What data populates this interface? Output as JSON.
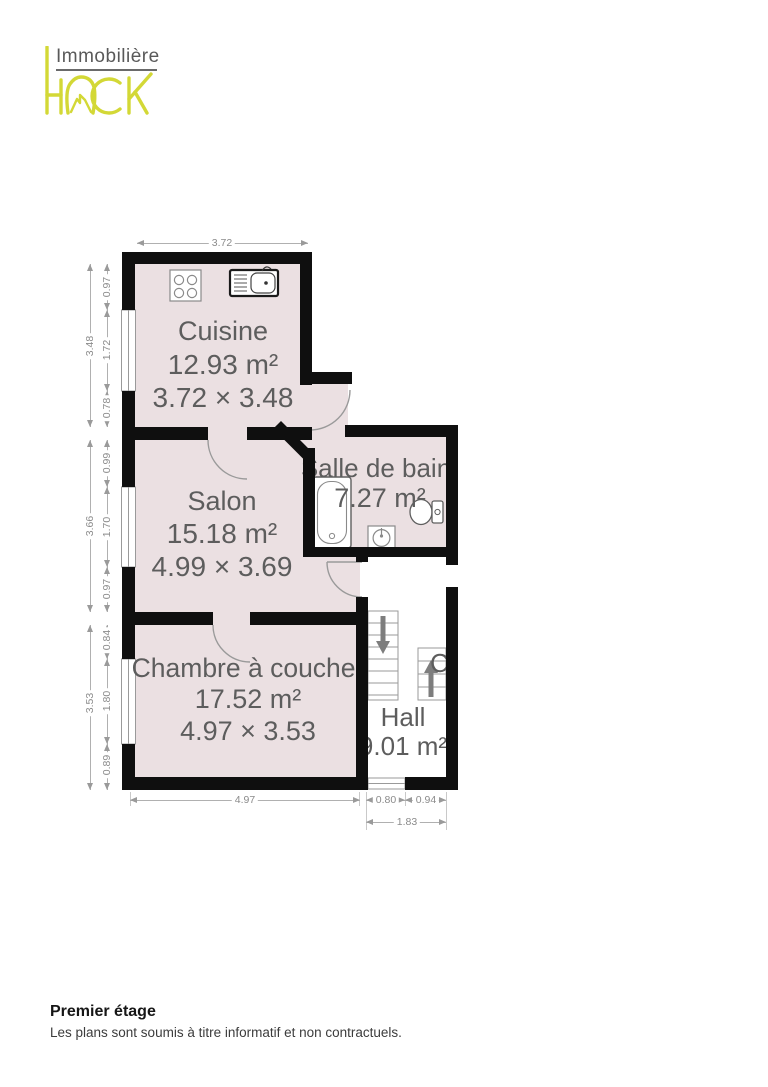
{
  "logo": {
    "brand_line": "Immobilière",
    "brand_word": "HACK"
  },
  "rooms": {
    "cuisine": {
      "name": "Cuisine",
      "area": "12.93 m²",
      "size": "3.72 × 3.48"
    },
    "salon": {
      "name": "Salon",
      "area": "15.18 m²",
      "size": "4.99 × 3.69"
    },
    "salle_de_bain": {
      "name": "Salle de bain",
      "area": "7.27 m²"
    },
    "chambre": {
      "name": "Chambre à coucher",
      "area": "17.52 m²",
      "size": "4.97 × 3.53"
    },
    "hall": {
      "name": "Hall",
      "area": "9.01 m²"
    },
    "adjacent_room_partial_label": "C"
  },
  "dimensions": {
    "top": {
      "width": "3.72"
    },
    "left": {
      "cuisine_total": "3.48",
      "cuisine_segments": [
        "0.97",
        "1.72",
        "0.78"
      ],
      "salon_total": "3.66",
      "salon_segments": [
        "0.99",
        "1.70",
        "0.97"
      ],
      "chambre_total": "3.53",
      "chambre_segments": [
        "0.84",
        "1.80",
        "0.89"
      ]
    },
    "bottom": {
      "chambre_width": "4.97",
      "hall_segments": [
        "0.80",
        "0.94"
      ],
      "hall_total": "1.83"
    }
  },
  "footer": {
    "title": "Premier étage",
    "disclaimer": "Les plans sont soumis à titre informatif et non contractuels."
  },
  "colors": {
    "accent_yellow": "#d3d836",
    "wall_black": "#0f0f0f",
    "room_fill_pink": "#ebe0e2",
    "label_gray": "#5d5d5d",
    "dimension_gray": "#8b8b8b"
  }
}
